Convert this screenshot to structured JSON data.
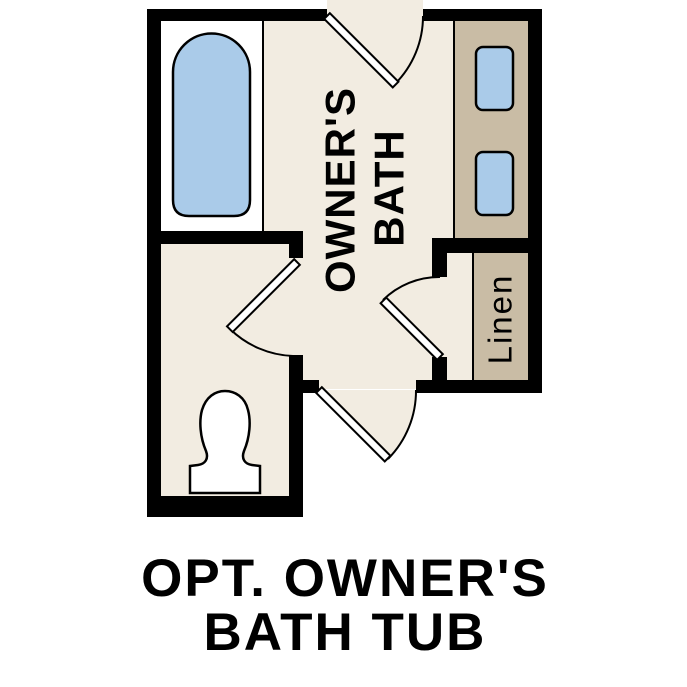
{
  "caption": {
    "line1": "OPT. OWNER'S",
    "line2": "BATH TUB"
  },
  "rooms": {
    "owners_bath": {
      "label_line1": "OWNER'S",
      "label_line2": "BATH"
    },
    "linen": {
      "label": "Linen"
    }
  },
  "colors": {
    "background": "#FFFFFF",
    "floor": "#F2ECE1",
    "cabinet": "#C9BCA5",
    "fixture": "#AACBE9",
    "toilet": "#FFFFFF",
    "wall": "#000000",
    "line": "#000000"
  }
}
